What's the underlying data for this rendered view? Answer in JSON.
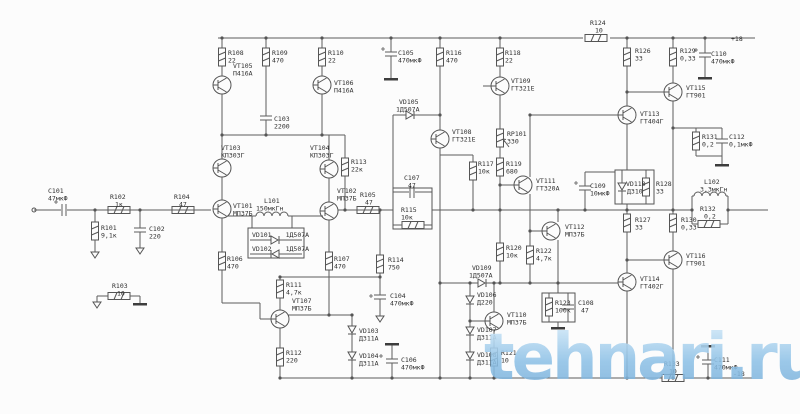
{
  "watermark": {
    "text": "tehnari.ru"
  },
  "power": {
    "positive": "+18",
    "negative": "-18"
  },
  "colors": {
    "wire": "#5d5d5d",
    "label": "#2f2f2f",
    "watermark_blue": "#8ec1e6",
    "background": "#fcfcfc"
  },
  "components": {
    "c101": {
      "ref": "C101",
      "value": "47мкФ"
    },
    "r101": {
      "ref": "R101",
      "value": "9,1к"
    },
    "r102": {
      "ref": "R102",
      "value": "1к"
    },
    "c102": {
      "ref": "C102",
      "value": "220"
    },
    "r103": {
      "ref": "R103",
      "value": "10"
    },
    "r104": {
      "ref": "R104",
      "value": "47"
    },
    "vt101": {
      "ref": "VT101",
      "value": "МП37Б"
    },
    "vt102": {
      "ref": "VT102",
      "value": "МП37Б"
    },
    "vt103": {
      "ref": "VT103",
      "value": "КП303Г"
    },
    "vt104": {
      "ref": "VT104",
      "value": "КП303Г"
    },
    "vt105": {
      "ref": "VT105",
      "value": "П416А"
    },
    "vt106": {
      "ref": "VT106",
      "value": "П416А"
    },
    "r108": {
      "ref": "R108",
      "value": "22"
    },
    "r109": {
      "ref": "R109",
      "value": "470"
    },
    "r110": {
      "ref": "R110",
      "value": "22"
    },
    "c103": {
      "ref": "C103",
      "value": "2200"
    },
    "r106": {
      "ref": "R106",
      "value": "470"
    },
    "r107": {
      "ref": "R107",
      "value": "470"
    },
    "l101": {
      "ref": "L101",
      "value": "150мкГн"
    },
    "vd101": {
      "ref": "VD101",
      "value": "1Д507А"
    },
    "vd102": {
      "ref": "VD102",
      "value": "1Д507А"
    },
    "r111": {
      "ref": "R111",
      "value": "4,7к"
    },
    "vt107": {
      "ref": "VT107",
      "value": "МП37Б"
    },
    "r112": {
      "ref": "R112",
      "value": "220"
    },
    "r113": {
      "ref": "R113",
      "value": "22к"
    },
    "r105": {
      "ref": "R105",
      "value": "47"
    },
    "r114": {
      "ref": "R114",
      "value": "750"
    },
    "c104": {
      "ref": "C104",
      "value": "470мкФ"
    },
    "vd103": {
      "ref": "VD103",
      "value": "Д311А"
    },
    "vd104": {
      "ref": "VD104",
      "value": "Д311А"
    },
    "c106": {
      "ref": "C106",
      "value": "470мкФ"
    },
    "c105": {
      "ref": "C105",
      "value": "470мкФ"
    },
    "r116": {
      "ref": "R116",
      "value": "470"
    },
    "r118": {
      "ref": "R118",
      "value": "22"
    },
    "vd105": {
      "ref": "VD105",
      "value": "1Д507А"
    },
    "vt108": {
      "ref": "VT108",
      "value": "ГТ321Е"
    },
    "vt109": {
      "ref": "VT109",
      "value": "ГТ321Е"
    },
    "c107": {
      "ref": "C107",
      "value": "47"
    },
    "r115": {
      "ref": "R115",
      "value": "10к"
    },
    "r117": {
      "ref": "R117",
      "value": "10к"
    },
    "rp101": {
      "ref": "RP101",
      "value": "330"
    },
    "r119": {
      "ref": "R119",
      "value": "680"
    },
    "vt111": {
      "ref": "VT111",
      "value": "ГТ320А"
    },
    "r120": {
      "ref": "R120",
      "value": "10к"
    },
    "r122": {
      "ref": "R122",
      "value": "4,7к"
    },
    "vt112": {
      "ref": "VT112",
      "value": "МП37Б"
    },
    "vd109": {
      "ref": "VD109",
      "value": "1Д507А"
    },
    "vd106": {
      "ref": "VD106",
      "value": "Д220"
    },
    "vt110": {
      "ref": "VT110",
      "value": "МП37Б"
    },
    "vd107": {
      "ref": "VD107",
      "value": "Д311А"
    },
    "vd108": {
      "ref": "VD108",
      "value": "Д311А"
    },
    "r121": {
      "ref": "R121",
      "value": "10"
    },
    "r123": {
      "ref": "R123",
      "value": "100к"
    },
    "c108": {
      "ref": "C108",
      "value": "47"
    },
    "r124": {
      "ref": "R124",
      "value": "10"
    },
    "r126": {
      "ref": "R126",
      "value": "33"
    },
    "r129": {
      "ref": "R129",
      "value": "0,33"
    },
    "c110": {
      "ref": "C110",
      "value": "470мкФ"
    },
    "vt113": {
      "ref": "VT113",
      "value": "ГТ404Г"
    },
    "vt115": {
      "ref": "VT115",
      "value": "ГТ901"
    },
    "c109": {
      "ref": "C109",
      "value": "10мкФ"
    },
    "vd110": {
      "ref": "VD110",
      "value": "Д310"
    },
    "r128": {
      "ref": "R128",
      "value": "33"
    },
    "r131": {
      "ref": "R131",
      "value": "0,2"
    },
    "c112": {
      "ref": "C112",
      "value": "0,1мкФ"
    },
    "r127": {
      "ref": "R127",
      "value": "33"
    },
    "r130": {
      "ref": "R130",
      "value": "0,33"
    },
    "l102": {
      "ref": "L102",
      "value": "3,3мкГн"
    },
    "r132": {
      "ref": "R132",
      "value": "0,2"
    },
    "vt114": {
      "ref": "VT114",
      "value": "ГТ402Г"
    },
    "vt116": {
      "ref": "VT116",
      "value": "ГТ901"
    },
    "r133": {
      "ref": "R133",
      "value": "10"
    },
    "c111": {
      "ref": "C111",
      "value": "470мкФ"
    }
  }
}
